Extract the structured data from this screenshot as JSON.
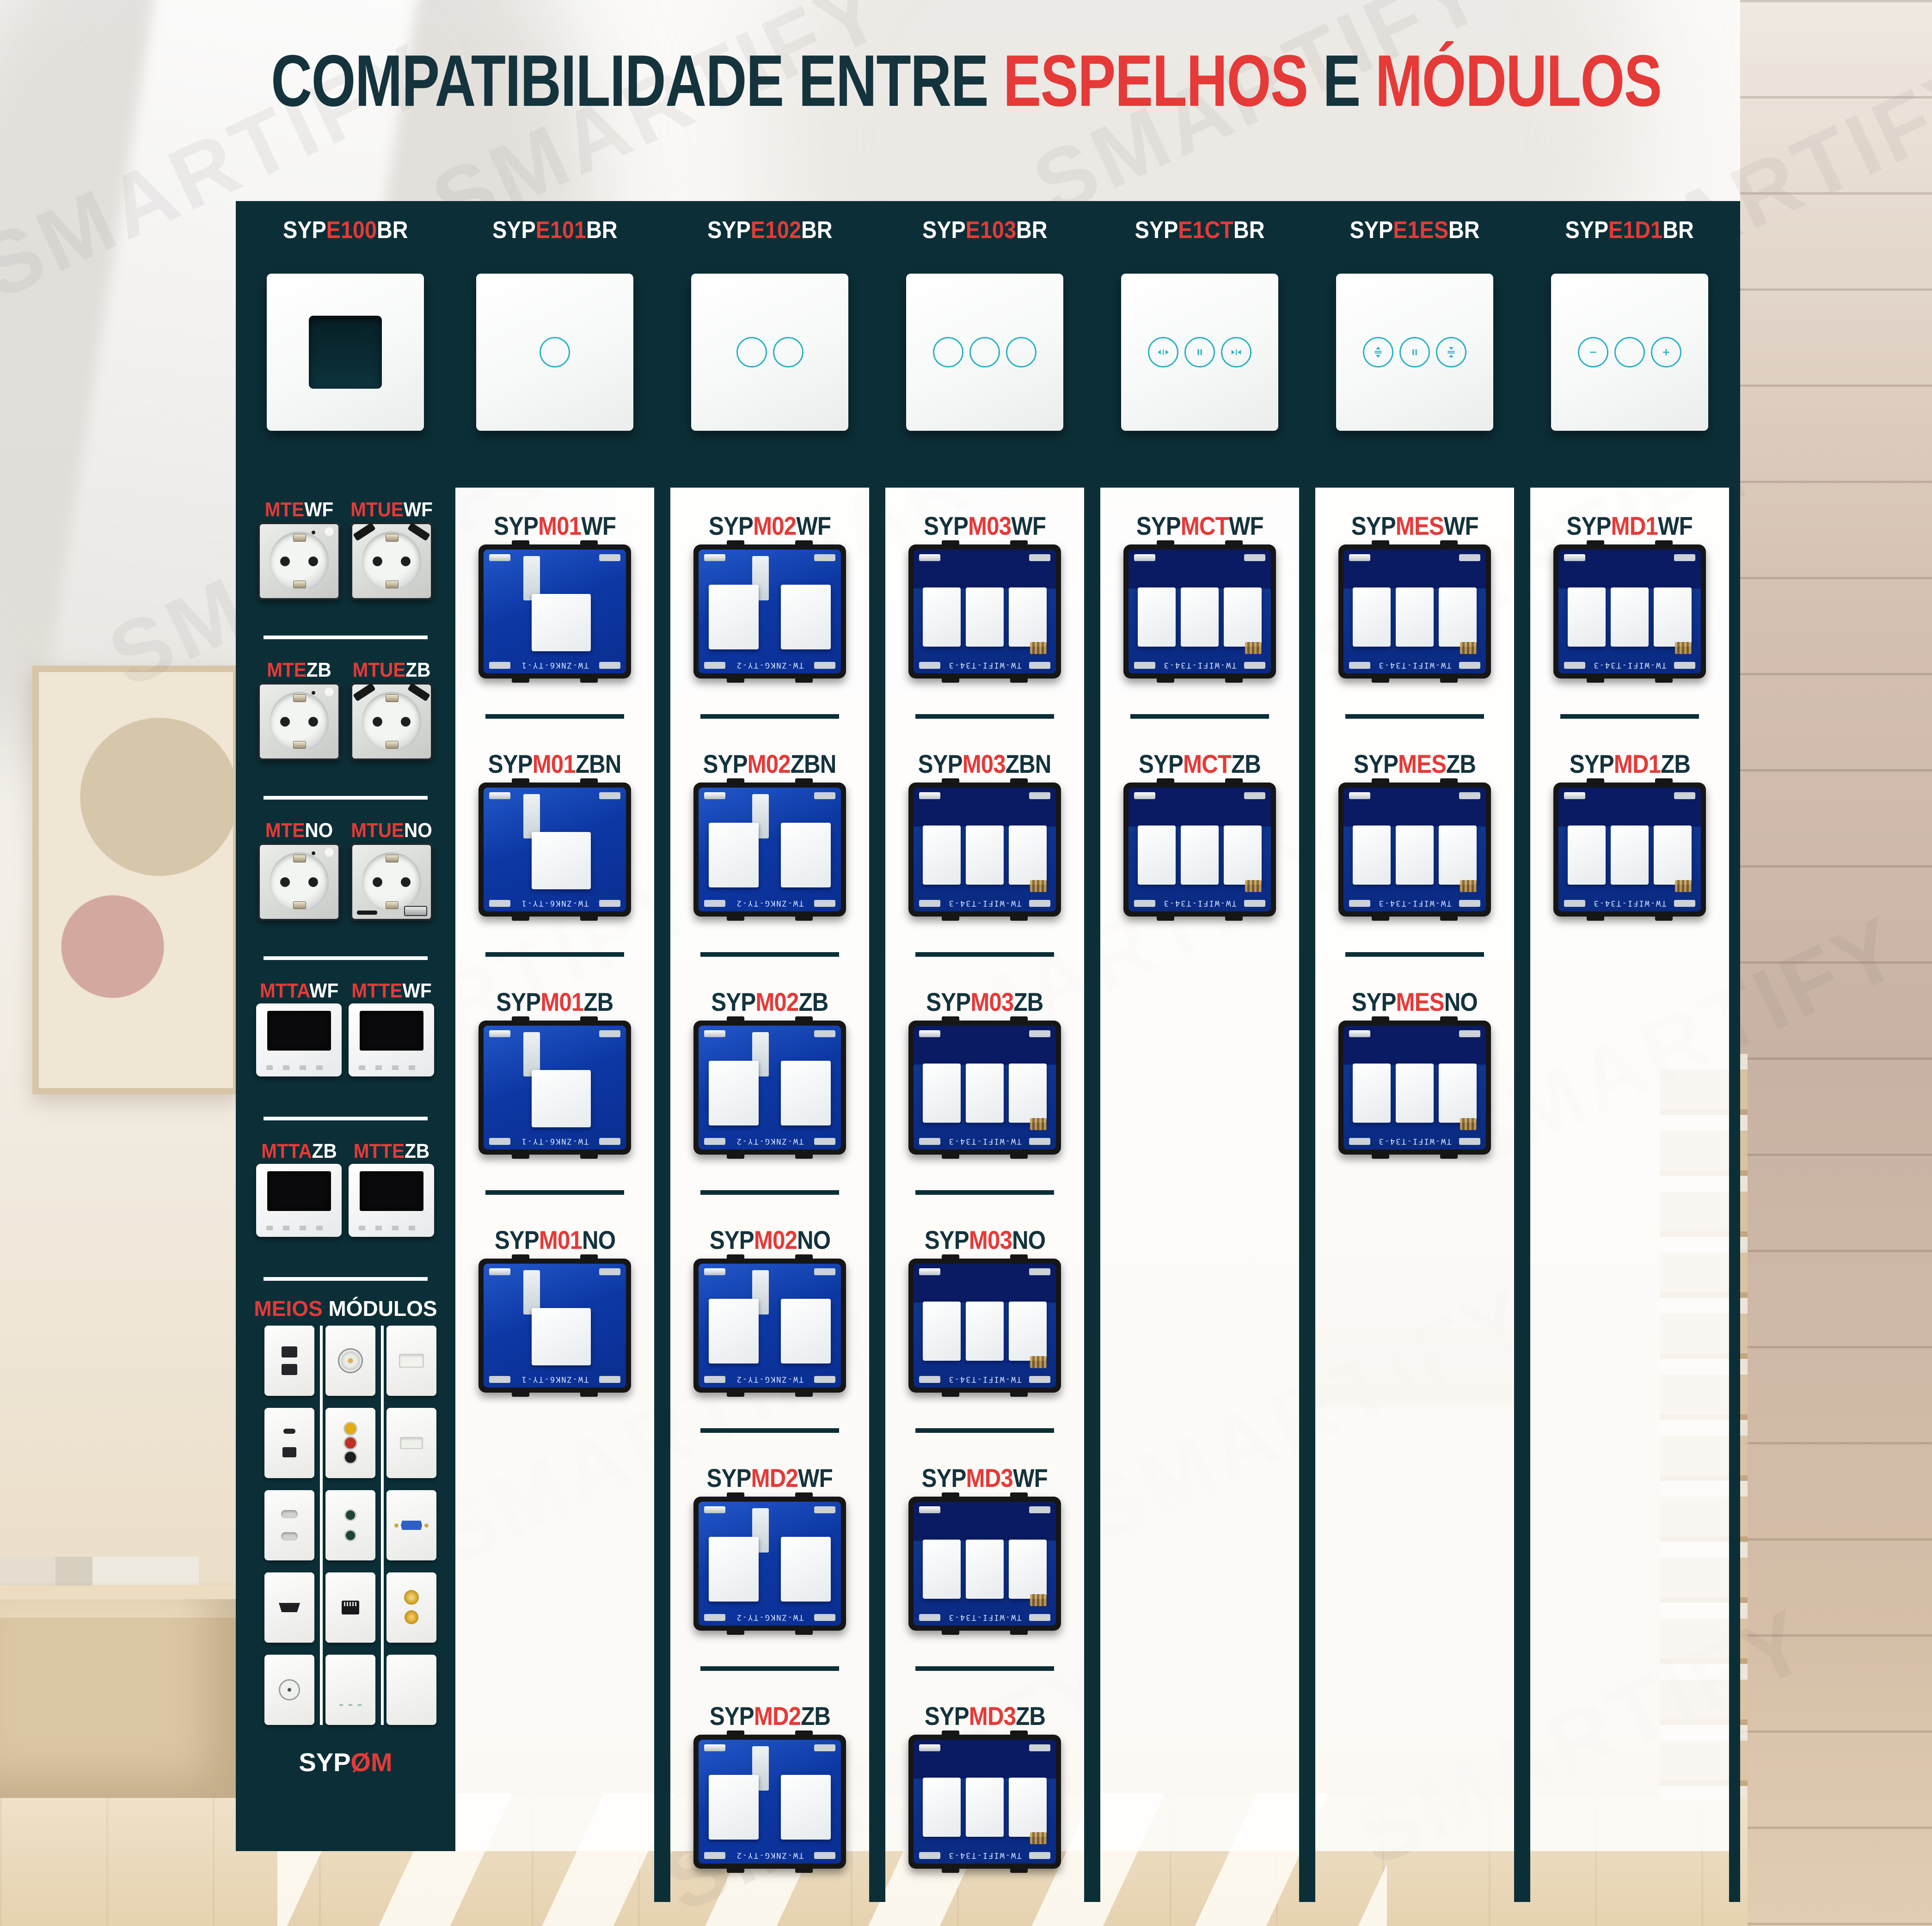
{
  "title": {
    "part1": "COMPATIBILIDADE ENTRE ",
    "part2": "ESPELHOS",
    "part3": " E ",
    "part4": "MÓDULOS"
  },
  "watermark": "SMARTIFY",
  "colors": {
    "dark_teal": "#0c2f37",
    "red": "#e53a38",
    "touch_icon_teal": "#27b2c4"
  },
  "header": {
    "mirrors": [
      {
        "pre": "SYP",
        "mid": "E100",
        "suf": "BR",
        "icon": "open-frame"
      },
      {
        "pre": "SYP",
        "mid": "E101",
        "suf": "BR",
        "icon": "touch-1-circle"
      },
      {
        "pre": "SYP",
        "mid": "E102",
        "suf": "BR",
        "icon": "touch-2-circles"
      },
      {
        "pre": "SYP",
        "mid": "E103",
        "suf": "BR",
        "icon": "touch-3-circles"
      },
      {
        "pre": "SYP",
        "mid": "E1CT",
        "suf": "BR",
        "icon": "curtain-open-pause-close"
      },
      {
        "pre": "SYP",
        "mid": "E1ES",
        "suf": "BR",
        "icon": "shutter-open-pause-close"
      },
      {
        "pre": "SYP",
        "mid": "E1D1",
        "suf": "BR",
        "icon": "dimmer-minus-plus"
      }
    ]
  },
  "sidebar": {
    "pairs": [
      {
        "left": {
          "red": "MTE",
          "rest": "WF"
        },
        "right": {
          "red": "MTUE",
          "rest": "WF"
        },
        "kind": "schuko-socket / schuko-socket-usb"
      },
      {
        "left": {
          "red": "MTE",
          "rest": "ZB"
        },
        "right": {
          "red": "MTUE",
          "rest": "ZB"
        },
        "kind": "schuko-socket / schuko-socket-usb"
      },
      {
        "left": {
          "red": "MTE",
          "rest": "NO"
        },
        "right": {
          "red": "MTUE",
          "rest": "NO"
        },
        "kind": "schuko-socket / schuko-socket-usb-bottom"
      },
      {
        "left": {
          "red": "MTTA",
          "rest": "WF"
        },
        "right": {
          "red": "MTTE",
          "rest": "WF"
        },
        "kind": "thermostat-display"
      },
      {
        "left": {
          "red": "MTTA",
          "rest": "ZB"
        },
        "right": {
          "red": "MTTE",
          "rest": "ZB"
        },
        "kind": "thermostat-display"
      }
    ],
    "meios": {
      "red": "MEIOS",
      "rest": " MÓDULOS"
    },
    "meios_tiles": [
      "usb-dual",
      "speaker",
      "blank-port",
      "usb-c-and-a",
      "rca-av",
      "blank-port",
      "socket-2pin",
      "audio-jack-dual",
      "vga",
      "hdmi",
      "rj45",
      "sat-coax-dual",
      "tv-coax",
      "switch-blank",
      "blank"
    ],
    "sypom": {
      "white": "SYP",
      "red": "ØM"
    }
  },
  "columns": [
    {
      "rows": [
        {
          "pre": "SYP",
          "mid": "M01",
          "suf": "WF",
          "variant": "m1",
          "pcb": "TW-ZNK6-TY-1"
        },
        {
          "pre": "SYP",
          "mid": "M01",
          "suf": "ZBN",
          "variant": "m1",
          "pcb": "TW-ZNK6-TY-1"
        },
        {
          "pre": "SYP",
          "mid": "M01",
          "suf": "ZB",
          "variant": "m1",
          "pcb": "TW-ZNK6-TY-1"
        },
        {
          "pre": "SYP",
          "mid": "M01",
          "suf": "NO",
          "variant": "m1",
          "pcb": "TW-ZNK6-TY-1"
        }
      ]
    },
    {
      "rows": [
        {
          "pre": "SYP",
          "mid": "M02",
          "suf": "WF",
          "variant": "m2",
          "pcb": "TW-ZNKG-TY-2"
        },
        {
          "pre": "SYP",
          "mid": "M02",
          "suf": "ZBN",
          "variant": "m2",
          "pcb": "TW-ZNKG-TY-2"
        },
        {
          "pre": "SYP",
          "mid": "M02",
          "suf": "ZB",
          "variant": "m2",
          "pcb": "TW-ZNKG-TY-2"
        },
        {
          "pre": "SYP",
          "mid": "M02",
          "suf": "NO",
          "variant": "m2",
          "pcb": "TW-ZNKG-TY-2"
        },
        {
          "pre": "SYP",
          "mid": "MD2",
          "suf": "WF",
          "variant": "m2",
          "pcb": "TW-ZNKG-TY-2"
        },
        {
          "pre": "SYP",
          "mid": "MD2",
          "suf": "ZB",
          "variant": "m2",
          "pcb": "TW-ZNKG-TY-2"
        }
      ]
    },
    {
      "rows": [
        {
          "pre": "SYP",
          "mid": "M03",
          "suf": "WF",
          "variant": "m3",
          "pcb": "TW-WIFI-T34-3"
        },
        {
          "pre": "SYP",
          "mid": "M03",
          "suf": "ZBN",
          "variant": "m3",
          "pcb": "TW-WIFI-T34-3"
        },
        {
          "pre": "SYP",
          "mid": "M03",
          "suf": "ZB",
          "variant": "m3",
          "pcb": "TW-WIFI-T34-3"
        },
        {
          "pre": "SYP",
          "mid": "M03",
          "suf": "NO",
          "variant": "m3",
          "pcb": "TW-WIFI-T34-3"
        },
        {
          "pre": "SYP",
          "mid": "MD3",
          "suf": "WF",
          "variant": "m3",
          "pcb": "TW-WIFI-T34-3"
        },
        {
          "pre": "SYP",
          "mid": "MD3",
          "suf": "ZB",
          "variant": "m3",
          "pcb": "TW-WIFI-T34-3"
        }
      ]
    },
    {
      "rows": [
        {
          "pre": "SYP",
          "mid": "MCT",
          "suf": "WF",
          "variant": "m3",
          "pcb": "TW-WIFI-T34-3"
        },
        {
          "pre": "SYP",
          "mid": "MCT",
          "suf": "ZB",
          "variant": "m3",
          "pcb": "TW-WIFI-T34-3"
        }
      ]
    },
    {
      "rows": [
        {
          "pre": "SYP",
          "mid": "MES",
          "suf": "WF",
          "variant": "m3",
          "pcb": "TW-WIFI-T34-3"
        },
        {
          "pre": "SYP",
          "mid": "MES",
          "suf": "ZB",
          "variant": "m3",
          "pcb": "TW-WIFI-T34-3"
        },
        {
          "pre": "SYP",
          "mid": "MES",
          "suf": "NO",
          "variant": "m3",
          "pcb": "TW-WIFI-T34-3"
        }
      ]
    },
    {
      "rows": [
        {
          "pre": "SYP",
          "mid": "MD1",
          "suf": "WF",
          "variant": "m3",
          "pcb": "TW-WIFI-T34-3"
        },
        {
          "pre": "SYP",
          "mid": "MD1",
          "suf": "ZB",
          "variant": "m3",
          "pcb": "TW-WIFI-T34-3"
        }
      ]
    }
  ]
}
